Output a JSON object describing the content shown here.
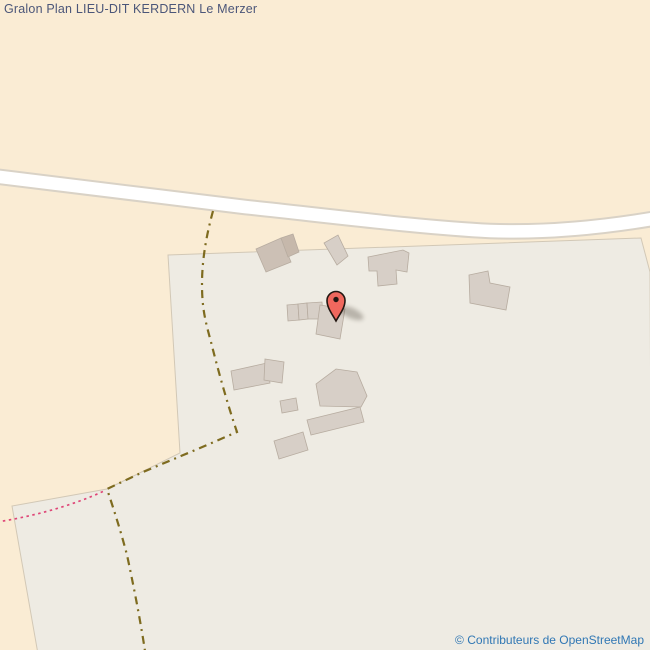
{
  "header": {
    "title": "Gralon Plan LIEU-DIT KERDERN Le Merzer"
  },
  "attribution": {
    "text": "© Contributeurs de OpenStreetMap"
  },
  "colors": {
    "farmland": "#faecd4",
    "landuse_gray": "#eeebe3",
    "landuse_border": "#d2c8b6",
    "road_fill": "#ffffff",
    "road_casing": "#d9d2c6",
    "track": "#7e6b1f",
    "boundary_pink": "#df4677",
    "building_fill": "#d7cfc7",
    "building_fill_brown": "#ccc0b5",
    "building_fill_brown_dark": "#c6b8ab",
    "building_border": "#b7aca0",
    "marker_red": "#f0685e",
    "marker_outline": "#231712",
    "marker_shadow": "#4a3f35",
    "title_color": "#4b5679",
    "attribution_color": "#3077b4"
  },
  "map": {
    "areas": [
      {
        "name": "landuse-area",
        "points": "168,255 641,238 650,272 652,654 38,654 12,506 107,489 180,453",
        "fill": "landuse_gray",
        "stroke": "landuse_border"
      }
    ],
    "roads": [
      {
        "name": "road-unclassified",
        "d": "M -8,176 C 80,186 160,197 245,207 C 330,216 425,228 490,231 C 545,233 600,228 658,218",
        "casing_width": 16.5,
        "fill_width": 12.5
      }
    ],
    "paths": [
      {
        "name": "track-path",
        "d": "M213,211 C207,233 202,258 202,284 C202,308 205,320 211,342 C217,366 227,403 237,432 L200,448 L143,472 L107,489 C111,501 120,528 127,555 C133,583 140,618 145,651",
        "stroke": "track",
        "width": 2.2,
        "dash": "8 5 2 5"
      },
      {
        "name": "boundary-path",
        "d": "M-3,522 C30,517 72,506 104,491",
        "stroke": "boundary_pink",
        "width": 1.7,
        "dash": "2.5 3.5"
      }
    ],
    "buildings": [
      {
        "points": "256,249 281,238 291,262 266,272",
        "fill": "building_fill_brown"
      },
      {
        "points": "281,238 293,234 299,252 288,257",
        "fill": "building_fill_brown_dark"
      },
      {
        "points": "338,235 348,256 337,265 324,243",
        "fill": "building_fill"
      },
      {
        "points": "368,257 403,250 409,253 407,272 396,270 397,284 378,286 377,271 369,271",
        "fill": "building_fill"
      },
      {
        "points": "469,275 488,271 490,283 510,287 506,310 470,303",
        "fill": "building_fill"
      },
      {
        "points": "287,305 298,304 299,320 288,321",
        "fill": "building_fill"
      },
      {
        "points": "298,304 307,303 308,319 299,320",
        "fill": "building_fill"
      },
      {
        "points": "307,303 322,302 323,319 308,319",
        "fill": "building_fill"
      },
      {
        "points": "320,305 345,309 340,339 316,334",
        "fill": "building_fill"
      },
      {
        "points": "231,371 267,363 270,383 234,390",
        "fill": "building_fill"
      },
      {
        "points": "265,359 284,362 282,383 264,380",
        "fill": "building_fill"
      },
      {
        "points": "280,401 296,398 298,410 282,413",
        "fill": "building_fill"
      },
      {
        "points": "336,369 357,372 367,396 361,407 320,406 316,384",
        "fill": "building_fill"
      },
      {
        "points": "307,420 360,407 364,422 311,435",
        "fill": "building_fill"
      },
      {
        "points": "274,441 303,432 308,450 279,459",
        "fill": "building_fill"
      }
    ]
  }
}
